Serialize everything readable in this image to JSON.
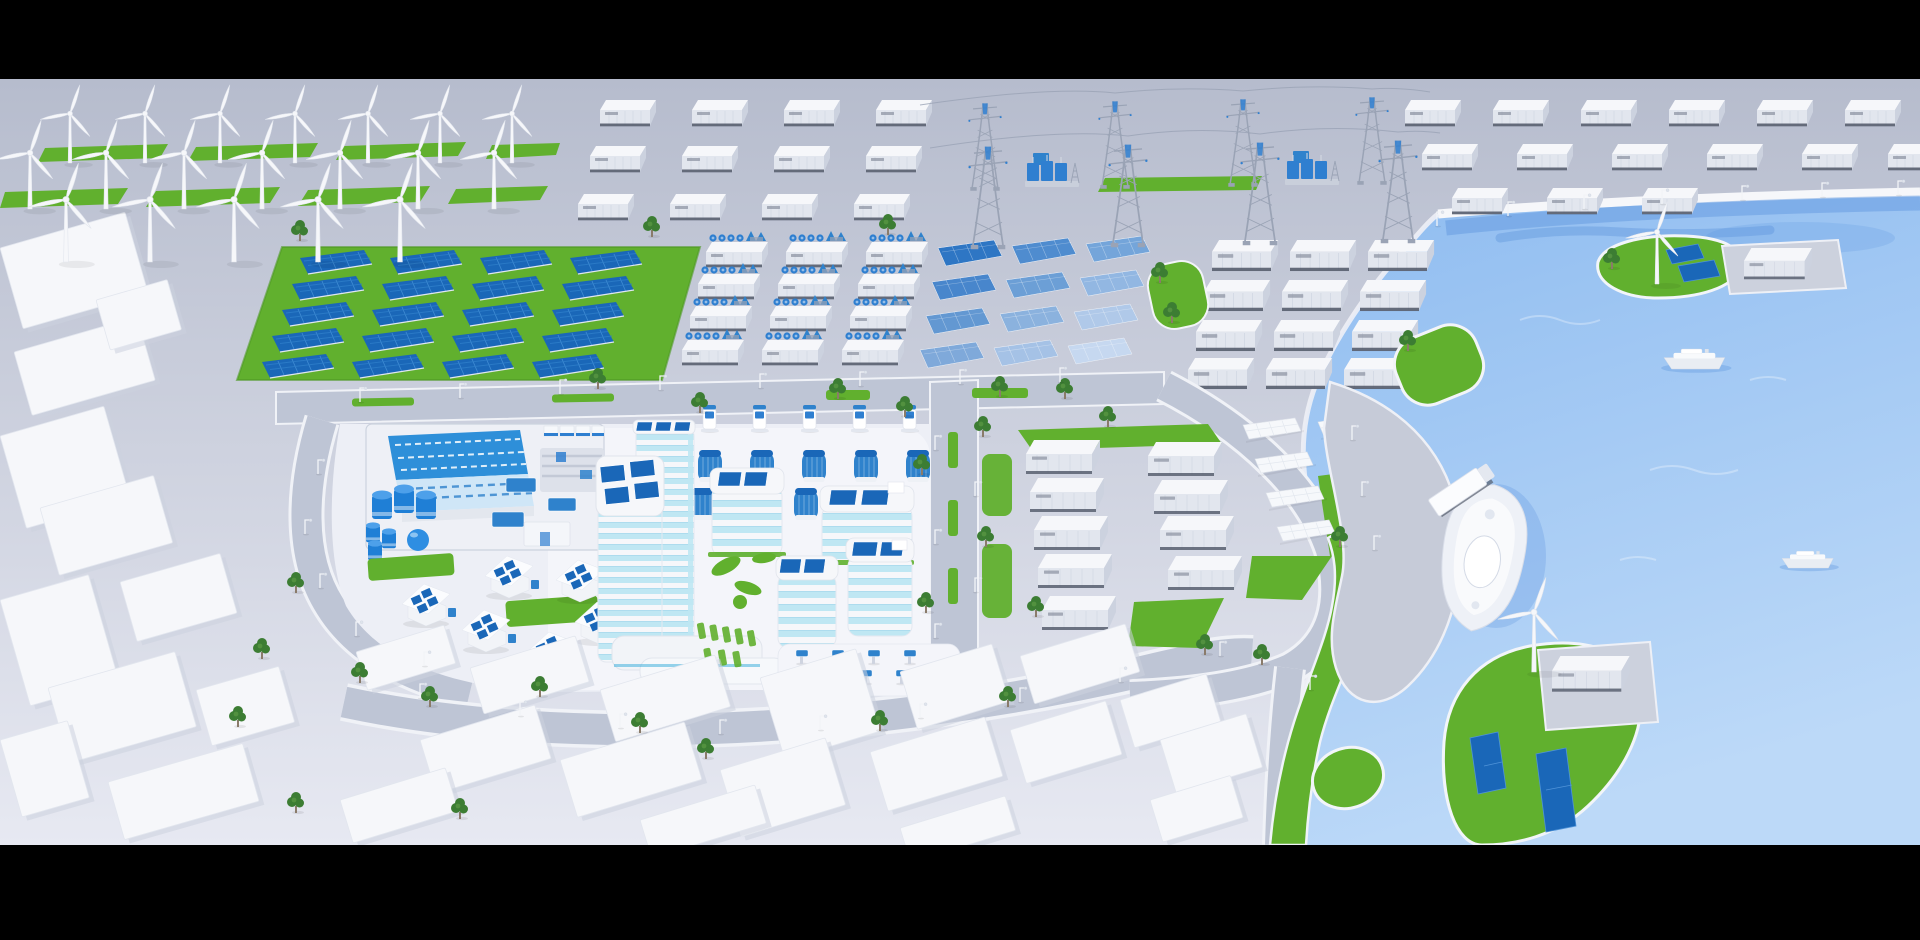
{
  "scene": {
    "description": "Isometric 3D render of a sustainable smart city: wind farm, solar farm, battery storage containers, electrical substation with pylons, hydrogen plant, solar-roof office campus, logistics district and a harbor with green islands, boats and a docked ship",
    "letterbox_top_height": 79,
    "letterbox_bottom_top": 845
  },
  "colors": {
    "letterbox": "#000000",
    "ground_far": "#b6bccd",
    "ground_near": "#e7e9f2",
    "road": "#bec5d5",
    "pad": "#edeff6",
    "pad_bright": "#f4f5fa",
    "grass": "#61b02e",
    "grass_deep": "#4f9a24",
    "tree": "#3c7d33",
    "tree_light": "#549340",
    "water": "#8fbcf0",
    "water_deep": "#5d94dd",
    "water_light": "#bcd9f8",
    "panel": "#1a67b8",
    "panel_mid": "#2f82cc",
    "accent": "#2f7fd0",
    "glass": "#bfe7f3",
    "glass_deep": "#2fa9da",
    "white": "#f6f7fa",
    "side": "#e2e6ee",
    "shade": "#ccd2df",
    "base_dark": "#4e5565",
    "steel": "#9aa3b5",
    "label": "#8a90a0",
    "tank": "#1f7fd6",
    "roof_blue": "#2e8fd9",
    "roof_pale": "#cfe6f7"
  },
  "placements": {
    "wind_turbines": {
      "symbol": "sym-turbine",
      "name": "wind-turbine",
      "items": [
        [
          70,
          163,
          0.95
        ],
        [
          145,
          163,
          0.95
        ],
        [
          220,
          163,
          0.95
        ],
        [
          295,
          163,
          0.95
        ],
        [
          368,
          163,
          0.95
        ],
        [
          440,
          163,
          0.95
        ],
        [
          512,
          163,
          0.95
        ],
        [
          30,
          209,
          1.08
        ],
        [
          106,
          209,
          1.08
        ],
        [
          184,
          209,
          1.08
        ],
        [
          262,
          209,
          1.08
        ],
        [
          340,
          209,
          1.08
        ],
        [
          418,
          209,
          1.08
        ],
        [
          494,
          209,
          1.08
        ],
        [
          66,
          262,
          1.2
        ],
        [
          150,
          262,
          1.2
        ],
        [
          234,
          262,
          1.2
        ],
        [
          318,
          262,
          1.2
        ],
        [
          400,
          262,
          1.2
        ]
      ]
    },
    "containers_topleft": {
      "symbol": "sym-container",
      "name": "battery-container",
      "items": [
        [
          600,
          100
        ],
        [
          692,
          100
        ],
        [
          784,
          100
        ],
        [
          876,
          100
        ],
        [
          590,
          146
        ],
        [
          682,
          146
        ],
        [
          774,
          146
        ],
        [
          866,
          146
        ],
        [
          578,
          194
        ],
        [
          670,
          194
        ],
        [
          762,
          194
        ],
        [
          854,
          194
        ]
      ]
    },
    "containers_topright": {
      "symbol": "sym-container",
      "name": "battery-container",
      "items": [
        [
          1405,
          100
        ],
        [
          1493,
          100
        ],
        [
          1581,
          100
        ],
        [
          1669,
          100
        ],
        [
          1757,
          100
        ],
        [
          1845,
          100
        ],
        [
          1422,
          144
        ],
        [
          1517,
          144
        ],
        [
          1612,
          144
        ],
        [
          1707,
          144
        ],
        [
          1802,
          144
        ],
        [
          1888,
          144
        ],
        [
          1452,
          188
        ],
        [
          1547,
          188
        ],
        [
          1642,
          188
        ]
      ]
    },
    "containers_center": {
      "symbol": "sym-container",
      "name": "battery-container",
      "scale": 1.18,
      "items": [
        [
          1212,
          240
        ],
        [
          1290,
          240
        ],
        [
          1368,
          240
        ],
        [
          1204,
          280
        ],
        [
          1282,
          280
        ],
        [
          1360,
          280
        ],
        [
          1196,
          320
        ],
        [
          1274,
          320
        ],
        [
          1352,
          320
        ],
        [
          1188,
          358
        ],
        [
          1266,
          358
        ],
        [
          1344,
          358
        ]
      ]
    },
    "fan_units": {
      "symbol": "sym-fanunit",
      "name": "electrolyzer-unit",
      "items": [
        [
          706,
          234
        ],
        [
          786,
          234
        ],
        [
          866,
          234
        ],
        [
          698,
          266
        ],
        [
          778,
          266
        ],
        [
          858,
          266
        ],
        [
          690,
          298
        ],
        [
          770,
          298
        ],
        [
          850,
          298
        ],
        [
          682,
          332
        ],
        [
          762,
          332
        ],
        [
          842,
          332
        ]
      ]
    },
    "solar_panels_dark": {
      "symbol": "sym-panel",
      "name": "solar-panel",
      "items": [
        [
          300,
          250
        ],
        [
          390,
          250
        ],
        [
          480,
          250
        ],
        [
          570,
          250
        ],
        [
          292,
          276
        ],
        [
          382,
          276
        ],
        [
          472,
          276
        ],
        [
          562,
          276
        ],
        [
          282,
          302
        ],
        [
          372,
          302
        ],
        [
          462,
          302
        ],
        [
          552,
          302
        ],
        [
          272,
          328
        ],
        [
          362,
          328
        ],
        [
          452,
          328
        ],
        [
          542,
          328
        ],
        [
          262,
          354
        ],
        [
          352,
          354
        ],
        [
          442,
          354
        ],
        [
          532,
          354
        ]
      ]
    },
    "gradient_panels": {
      "symbol": "sym-gpanel",
      "name": "solar-panel-gradient",
      "items": [
        [
          938,
          240,
          1,
          "#2e76c4"
        ],
        [
          1012,
          238,
          1,
          "#4f8ccf"
        ],
        [
          1086,
          236,
          1,
          "#74a5da"
        ],
        [
          932,
          274,
          1,
          "#4886cc"
        ],
        [
          1006,
          272,
          1,
          "#6c9fd6"
        ],
        [
          1080,
          270,
          1,
          "#92b7e2"
        ],
        [
          926,
          308,
          1,
          "#6398d2"
        ],
        [
          1000,
          306,
          1,
          "#8bb2de"
        ],
        [
          1074,
          304,
          1,
          "#b0c9e9"
        ],
        [
          920,
          342,
          1,
          "#7fa9da"
        ],
        [
          994,
          340,
          1,
          "#a5c2e6"
        ],
        [
          1068,
          338,
          1,
          "#c6d8f0"
        ]
      ]
    },
    "white_panels": {
      "symbol": "sym-wpanel",
      "name": "solar-panel-white",
      "items": [
        [
          1243,
          418
        ],
        [
          1318,
          415
        ],
        [
          1255,
          452
        ],
        [
          1330,
          450
        ],
        [
          1266,
          486
        ],
        [
          1341,
          484
        ],
        [
          1277,
          520
        ],
        [
          1352,
          518
        ]
      ]
    },
    "warehouses": {
      "symbol": "sym-warehouse",
      "name": "warehouse-container",
      "items": [
        [
          1026,
          440
        ],
        [
          1030,
          478
        ],
        [
          1034,
          516
        ],
        [
          1038,
          554
        ],
        [
          1042,
          596
        ],
        [
          1148,
          442
        ],
        [
          1154,
          480
        ],
        [
          1160,
          516
        ],
        [
          1168,
          556
        ]
      ]
    },
    "houses": {
      "symbol": "sym-house",
      "name": "solar-house",
      "items": [
        [
          402,
          584
        ],
        [
          462,
          610
        ],
        [
          527,
          632
        ],
        [
          485,
          556
        ],
        [
          556,
          560
        ],
        [
          575,
          602
        ]
      ]
    },
    "chargers": {
      "symbol": "sym-charger",
      "name": "ev-charging-station",
      "items": [
        [
          703,
          405
        ],
        [
          753,
          405
        ],
        [
          803,
          405
        ],
        [
          853,
          405
        ],
        [
          903,
          405
        ]
      ]
    },
    "barrels": {
      "symbol": "sym-barrel",
      "name": "solar-pod",
      "items": [
        [
          698,
          448
        ],
        [
          750,
          448
        ],
        [
          802,
          448
        ],
        [
          854,
          448
        ],
        [
          906,
          448
        ],
        [
          690,
          486
        ],
        [
          742,
          486
        ],
        [
          794,
          486
        ],
        [
          846,
          486
        ]
      ]
    },
    "kiosks": {
      "symbol": "sym-kiosk",
      "name": "plaza-kiosk",
      "items": [
        [
          800,
          650
        ],
        [
          836,
          650
        ],
        [
          872,
          650
        ],
        [
          908,
          650
        ],
        [
          792,
          670
        ],
        [
          828,
          670
        ],
        [
          864,
          670
        ],
        [
          900,
          670
        ]
      ]
    },
    "pylons": {
      "symbol": "sym-pylon",
      "name": "transmission-tower",
      "items": [
        [
          985,
          96,
          0.92
        ],
        [
          1115,
          94,
          0.92
        ],
        [
          1243,
          92,
          0.92
        ],
        [
          1372,
          90,
          0.92
        ],
        [
          988,
          138,
          1.08
        ],
        [
          1128,
          136,
          1.08
        ],
        [
          1260,
          134,
          1.08
        ],
        [
          1398,
          132,
          1.08
        ]
      ]
    },
    "transformers": {
      "symbol": "sym-transformer",
      "name": "substation-transformer",
      "items": [
        [
          1025,
          155
        ],
        [
          1285,
          153
        ]
      ]
    },
    "boats": {
      "symbol": "sym-ferry",
      "name": "ferry-boat",
      "items": [
        [
          1664,
          350,
          0.95
        ],
        [
          1782,
          552,
          0.8
        ]
      ]
    },
    "trees": {
      "symbol": "sym-tree",
      "name": "tree",
      "items": [
        [
          300,
          238
        ],
        [
          652,
          234
        ],
        [
          888,
          232
        ],
        [
          598,
          386
        ],
        [
          700,
          410
        ],
        [
          838,
          396
        ],
        [
          905,
          414
        ],
        [
          1000,
          394
        ],
        [
          1065,
          396
        ],
        [
          1108,
          424
        ],
        [
          983,
          434
        ],
        [
          922,
          472
        ],
        [
          986,
          544
        ],
        [
          926,
          610
        ],
        [
          1036,
          614
        ],
        [
          1205,
          652
        ],
        [
          1262,
          662
        ],
        [
          1340,
          544
        ],
        [
          296,
          590
        ],
        [
          262,
          656
        ],
        [
          238,
          724
        ],
        [
          296,
          810
        ],
        [
          460,
          816
        ],
        [
          360,
          680
        ],
        [
          430,
          704
        ],
        [
          540,
          694
        ],
        [
          640,
          730
        ],
        [
          706,
          756
        ],
        [
          880,
          728
        ],
        [
          1008,
          704
        ],
        [
          1160,
          280
        ],
        [
          1172,
          320
        ],
        [
          1408,
          348
        ],
        [
          1612,
          266
        ]
      ]
    },
    "lamps": {
      "symbol": "sym-lamp",
      "name": "street-lamp",
      "items": [
        [
          560,
          394
        ],
        [
          660,
          390
        ],
        [
          760,
          388
        ],
        [
          860,
          386
        ],
        [
          960,
          384
        ],
        [
          1060,
          382
        ],
        [
          460,
          398
        ],
        [
          360,
          402
        ],
        [
          935,
          450
        ],
        [
          975,
          496
        ],
        [
          935,
          544
        ],
        [
          975,
          592
        ],
        [
          935,
          638
        ],
        [
          318,
          474
        ],
        [
          305,
          534
        ],
        [
          320,
          588
        ],
        [
          356,
          636
        ],
        [
          424,
          666
        ],
        [
          420,
          698
        ],
        [
          520,
          716
        ],
        [
          620,
          728
        ],
        [
          720,
          734
        ],
        [
          820,
          730
        ],
        [
          920,
          718
        ],
        [
          1020,
          702
        ],
        [
          1120,
          682
        ],
        [
          1220,
          656
        ],
        [
          1437,
          226
        ],
        [
          1508,
          216
        ],
        [
          1584,
          209
        ],
        [
          1662,
          204
        ],
        [
          1742,
          200
        ],
        [
          1822,
          197
        ],
        [
          1898,
          195
        ],
        [
          1352,
          440
        ],
        [
          1362,
          496
        ],
        [
          1374,
          550
        ],
        [
          1310,
          690
        ]
      ]
    },
    "left_city_blocks": {
      "type": "block",
      "name": "city-building",
      "items": [
        [
          0,
          248,
          130,
          84,
          -16
        ],
        [
          14,
          352,
          128,
          66,
          -16
        ],
        [
          0,
          436,
          108,
          96,
          -16
        ],
        [
          96,
          300,
          74,
          52,
          -16
        ],
        [
          40,
          508,
          118,
          70,
          -16
        ],
        [
          0,
          600,
          92,
          110,
          -16
        ],
        [
          120,
          582,
          104,
          62,
          -16
        ],
        [
          48,
          688,
          132,
          78,
          -16
        ],
        [
          196,
          690,
          86,
          58,
          -16
        ],
        [
          108,
          782,
          140,
          60,
          -16
        ],
        [
          0,
          740,
          70,
          80,
          -16
        ]
      ]
    },
    "bottom_city_blocks": {
      "type": "block",
      "name": "city-building",
      "items": [
        [
          356,
          652,
          92,
          40,
          -17
        ],
        [
          470,
          668,
          110,
          48,
          -17
        ],
        [
          600,
          690,
          120,
          54,
          -17
        ],
        [
          760,
          678,
          100,
          86,
          -17
        ],
        [
          900,
          672,
          96,
          60,
          -17
        ],
        [
          1020,
          656,
          110,
          50,
          -17
        ],
        [
          420,
          740,
          120,
          56,
          -17
        ],
        [
          560,
          760,
          130,
          60,
          -17
        ],
        [
          720,
          770,
          110,
          70,
          -17
        ],
        [
          870,
          752,
          120,
          62,
          -17
        ],
        [
          1010,
          730,
          100,
          56,
          -17
        ],
        [
          1120,
          700,
          90,
          50,
          -17
        ],
        [
          340,
          800,
          110,
          45,
          -17
        ],
        [
          640,
          820,
          120,
          40,
          -17
        ],
        [
          900,
          828,
          110,
          36,
          -17
        ],
        [
          1160,
          740,
          90,
          56,
          -17
        ],
        [
          1150,
          800,
          84,
          44,
          -17
        ]
      ]
    }
  },
  "inventory": {
    "land_wind_turbines": 19,
    "island_wind_turbines": 2,
    "storage_containers": 39,
    "electrolyzer_units": 12,
    "dark_solar_panels": 20,
    "gradient_solar_panels": 12,
    "white_solar_panels": 8,
    "warehouses": 9,
    "solar_houses": 6,
    "ev_chargers": 5,
    "transmission_towers": 8,
    "transformers": 2,
    "boats": 2,
    "docked_ship": 1,
    "islands": 2
  }
}
